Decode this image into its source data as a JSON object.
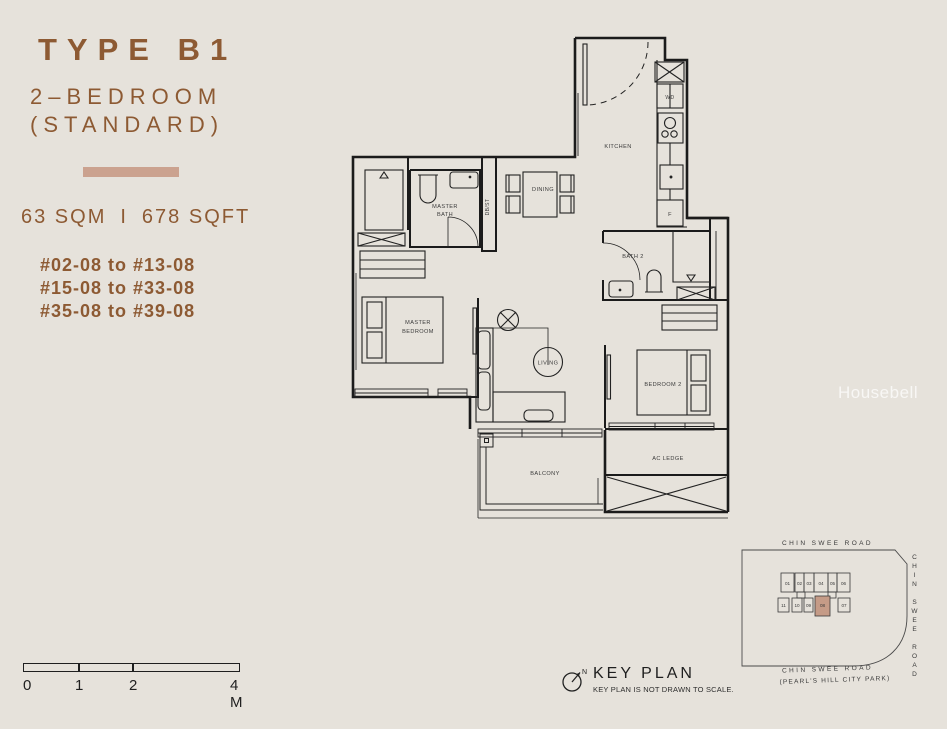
{
  "colors": {
    "background": "#E6E2DB",
    "accent": "#CBA28F",
    "title": "#8D5A33",
    "wall": "#1b1b1b",
    "keyplan_highlight": "#C59B87"
  },
  "info": {
    "type_title": "TYPE B1",
    "subtitle_line1": "2–BEDROOM",
    "subtitle_line2": "(STANDARD)",
    "area_sqm": "63 SQM",
    "area_sep": "I",
    "area_sqft": "678 SQFT",
    "stacks": [
      "#02-08 to #13-08",
      "#15-08 to #33-08",
      "#35-08 to #39-08"
    ]
  },
  "floorplan": {
    "rooms": {
      "kitchen": "KITCHEN",
      "dining": "DINING",
      "dbst": "DB/ST",
      "master_bath_line1": "MASTER",
      "master_bath_line2": "BATH",
      "master_bedroom_line1": "MASTER",
      "master_bedroom_line2": "BEDROOM",
      "living": "LIVING",
      "bath2": "BATH 2",
      "bedroom2": "BEDROOM 2",
      "balcony": "BALCONY",
      "ac_ledge": "AC LEDGE",
      "wd": "WD",
      "fridge": "F"
    }
  },
  "scalebar": {
    "labels": [
      "0",
      "1",
      "2",
      "4 M"
    ]
  },
  "keyplan": {
    "title": "KEY PLAN",
    "note": "KEY PLAN IS NOT DRAWN TO SCALE.",
    "north": "N",
    "road_top": "CHIN SWEE ROAD",
    "road_right": "CHIN SWEE ROAD",
    "road_bottom_line1": "CHIN SWEE ROAD",
    "road_bottom_line2": "(PEARL'S HILL CITY PARK)",
    "highlight_color": "#C59B87",
    "units": [
      {
        "label": "01"
      },
      {
        "label": "02"
      },
      {
        "label": "03"
      },
      {
        "label": "04"
      },
      {
        "label": "05"
      },
      {
        "label": "06"
      },
      {
        "label": "11"
      },
      {
        "label": "10"
      },
      {
        "label": "09"
      },
      {
        "label": "08"
      },
      {
        "label": "07"
      }
    ]
  },
  "watermark": "Housebell"
}
